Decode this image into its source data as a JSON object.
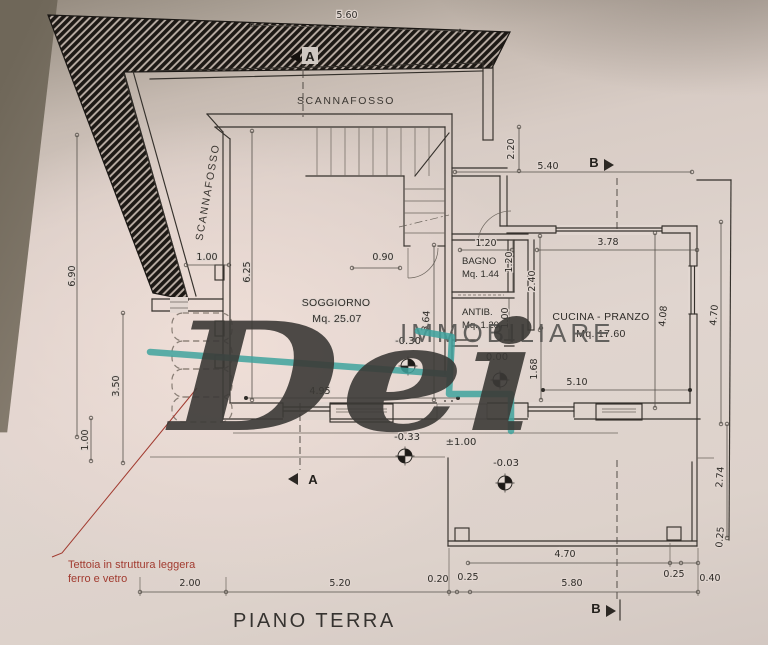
{
  "title": "PIANO TERRA",
  "watermark": {
    "script": "Dei",
    "word": "IMMOBILIARE"
  },
  "labels": {
    "scannafosso_top": "SCANNAFOSSO",
    "scannafosso_left": "SCANNAFOSSO"
  },
  "section_markers": {
    "a": "A",
    "b": "B"
  },
  "rooms": {
    "soggiorno": {
      "name": "SOGGIORNO",
      "area": "Mq. 25.07"
    },
    "bagno": {
      "name": "BAGNO",
      "area": "Mq. 1.44"
    },
    "antibagno": {
      "name": "ANTIB.",
      "area": "Mq. 1.20"
    },
    "cucina": {
      "name": "CUCINA - PRANZO",
      "area": "Mq. 17.60"
    }
  },
  "levels": {
    "soggiorno": "-0.30",
    "hall": "0.00",
    "south": "-0.33",
    "plus_one": "±1.00",
    "terrace": "-0.03"
  },
  "annotation": {
    "line1": "Tettoia in struttura leggera",
    "line2": "ferro e vetro"
  },
  "dims": {
    "top_width": "5.60",
    "stair_gap": "2.20",
    "north_width": "5.40",
    "west_height": "6.90",
    "tettoia_width": "1.00",
    "soggiorno_height": "6.25",
    "stair_door": "0.90",
    "bagno_width": "1.20",
    "bagno_height": "1.20",
    "cucina_top": "3.78",
    "cucina_west": "2.40",
    "antib_height": "1.00",
    "soggiorno_east": "3.64",
    "cucina_height": "4.08",
    "east_height": "4.70",
    "tettoia_height": "3.50",
    "soggiorno_width": "4.95",
    "cucina_width": "5.10",
    "hall_height": "1.68",
    "west_low": "1.00",
    "terrace_east": "2.74",
    "terrace_east_wall": "0.25",
    "terrace_width": "4.70",
    "terrace_wall_r": "0.25",
    "terrace_r": "0.40",
    "bottom_left": "2.00",
    "bottom_mid": "5.20",
    "bottom_s1": "0.20",
    "bottom_s2": "0.25",
    "bottom_right": "5.80"
  },
  "colors": {
    "paper": "#e2d7d1",
    "ink": "#35312c",
    "watermark_teal": "#3fa39e",
    "annotation_red": "#a23b30"
  }
}
